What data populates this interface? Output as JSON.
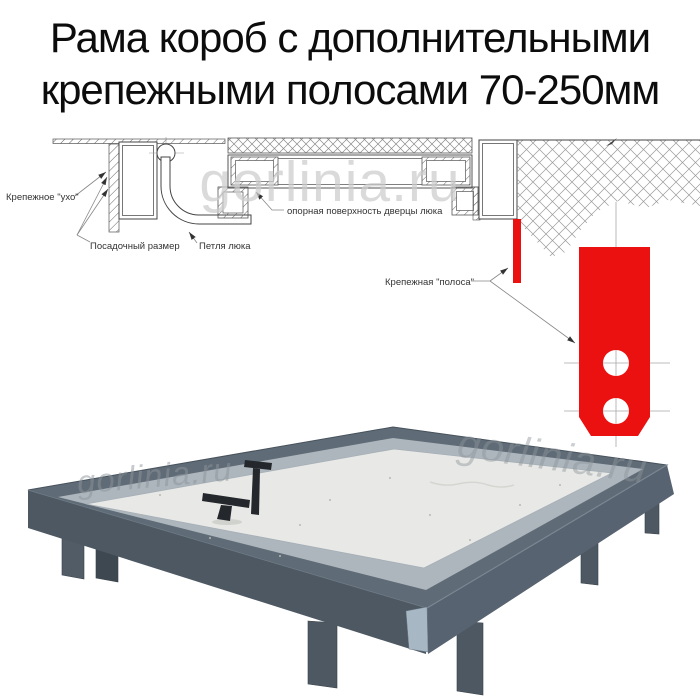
{
  "title": {
    "line1": "Рама короб с дополнительными",
    "line2": "крепежными полосами 70-250мм"
  },
  "watermark": "gorlinia.ru",
  "diagram": {
    "labels": {
      "ear": "Крепежное \"ухо\"",
      "seating": "Посадочный размер",
      "hinge": "Петля люка",
      "surface": "опорная поверхность дверцы люка",
      "strip": "Крепежная \"полоса\""
    }
  },
  "colors": {
    "accent_red": "#ec1111",
    "frame_gray": "#5f6b76",
    "frame_face_left": "#4d5862",
    "frame_face_right": "#576370",
    "panel_gray": "#e8e9e6",
    "edging_gray": "#adb6bd"
  }
}
